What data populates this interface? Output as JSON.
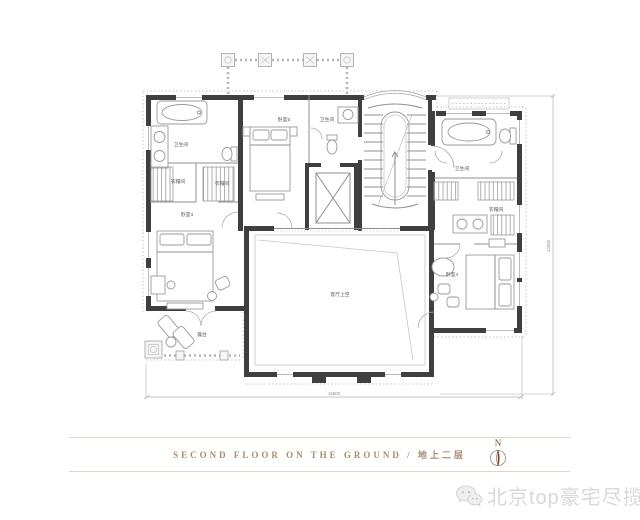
{
  "page": {
    "background": "#ffffff"
  },
  "plan": {
    "rooms": [
      {
        "id": "bathroom-left",
        "label": "卫生间"
      },
      {
        "id": "closet-left-1",
        "label": "衣帽间"
      },
      {
        "id": "closet-left-2",
        "label": "衣帽间"
      },
      {
        "id": "bedroom-3",
        "label": "卧室3"
      },
      {
        "id": "bedroom-5",
        "label": "卧室5"
      },
      {
        "id": "bathroom-center",
        "label": "卫生间"
      },
      {
        "id": "bathroom-right",
        "label": "卫生间"
      },
      {
        "id": "closet-right",
        "label": "衣帽间"
      },
      {
        "id": "bedroom-4",
        "label": "卧室4"
      },
      {
        "id": "living-room-void",
        "label": "客厅上空"
      },
      {
        "id": "terrace",
        "label": "露台"
      }
    ],
    "dimensions": {
      "bottom": "16600",
      "right": "13300"
    },
    "colors": {
      "wall": "#3f3f3f",
      "drawing_line": "#9a9a9a",
      "decor_border": "#c6c6c6"
    }
  },
  "caption": {
    "text": "SECOND FLOOR ON THE GROUND / 地上二层",
    "color": "#a88c6e"
  },
  "compass": {
    "label": "N",
    "needle_color": "#7a4527"
  },
  "watermark": {
    "text": "北京top豪宅尽揽",
    "icon": "wechat-icon",
    "color": "#d9d9d9"
  }
}
